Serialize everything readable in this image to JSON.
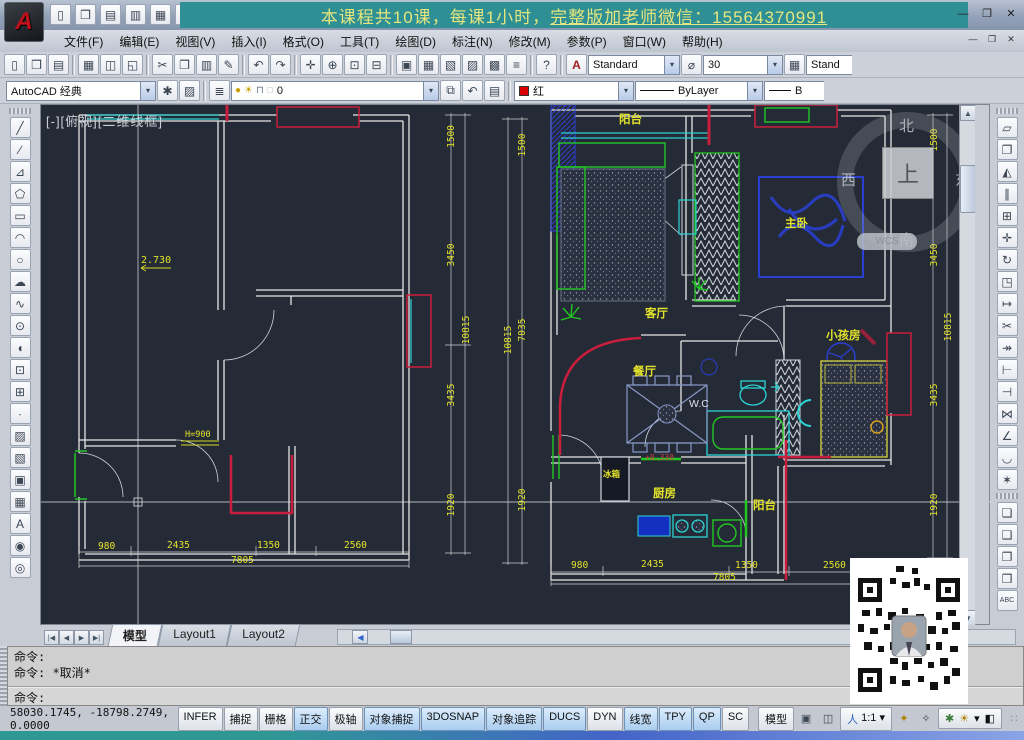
{
  "window": {
    "banner_part1": "本课程共10课，每课1小时，",
    "banner_part2": "完整版加老师微信：15564370991",
    "controls": {
      "minimize": "—",
      "maximize": "❐",
      "close": "✕"
    },
    "doc_controls": {
      "minimize": "—",
      "restore": "❐",
      "close": "✕"
    }
  },
  "menu": {
    "items": [
      "文件(F)",
      "编辑(E)",
      "视图(V)",
      "插入(I)",
      "格式(O)",
      "工具(T)",
      "绘图(D)",
      "标注(N)",
      "修改(M)",
      "参数(P)",
      "窗口(W)",
      "帮助(H)"
    ]
  },
  "toolbars": {
    "quick_access": [
      {
        "name": "new-icon",
        "glyph": "▯"
      },
      {
        "name": "open-icon",
        "glyph": "❒"
      },
      {
        "name": "save-icon",
        "glyph": "▤"
      },
      {
        "name": "saveas-icon",
        "glyph": "▥"
      },
      {
        "name": "plot-icon",
        "glyph": "▦"
      },
      {
        "name": "undo-icon",
        "glyph": "↶"
      }
    ],
    "standard": [
      {
        "name": "new-icon",
        "glyph": "▯"
      },
      {
        "name": "open-icon",
        "glyph": "❒"
      },
      {
        "name": "save-icon",
        "glyph": "▤"
      },
      {
        "sep": true
      },
      {
        "name": "plot-icon",
        "glyph": "▦"
      },
      {
        "name": "plot-preview-icon",
        "glyph": "◫"
      },
      {
        "name": "publish-icon",
        "glyph": "◱"
      },
      {
        "sep": true
      },
      {
        "name": "cut-icon",
        "glyph": "✂"
      },
      {
        "name": "copy-icon",
        "glyph": "❐"
      },
      {
        "name": "paste-icon",
        "glyph": "▥"
      },
      {
        "name": "match-properties-icon",
        "glyph": "✎"
      },
      {
        "sep": true
      },
      {
        "name": "undo-icon",
        "glyph": "↶"
      },
      {
        "name": "redo-icon",
        "glyph": "↷"
      },
      {
        "sep": true
      },
      {
        "name": "pan-icon",
        "glyph": "✛"
      },
      {
        "name": "zoom-realtime-icon",
        "glyph": "⊕"
      },
      {
        "name": "zoom-window-icon",
        "glyph": "⊡"
      },
      {
        "name": "zoom-previous-icon",
        "glyph": "⊟"
      },
      {
        "sep": true
      },
      {
        "name": "properties-icon",
        "glyph": "▣"
      },
      {
        "name": "designcenter-icon",
        "glyph": "▦"
      },
      {
        "name": "tool-palettes-icon",
        "glyph": "▧"
      },
      {
        "name": "sheet-set-icon",
        "glyph": "▨"
      },
      {
        "name": "markup-icon",
        "glyph": "▩"
      },
      {
        "name": "quickcalc-icon",
        "glyph": "≡"
      },
      {
        "sep": true
      },
      {
        "name": "help-icon",
        "glyph": "?"
      }
    ],
    "styles": {
      "text_style": "Standard",
      "dim_scale": "30",
      "dim_style": "Stand"
    },
    "workspace": {
      "value": "AutoCAD 经典"
    },
    "layers": {
      "current": "0"
    },
    "properties": {
      "color": "红",
      "linetype": "ByLayer",
      "lineweight": "B"
    }
  },
  "draw_tools": [
    {
      "name": "line-icon",
      "glyph": "╱"
    },
    {
      "name": "construction-line-icon",
      "glyph": "∕"
    },
    {
      "name": "polyline-icon",
      "glyph": "⊿"
    },
    {
      "name": "polygon-icon",
      "glyph": "⬠"
    },
    {
      "name": "rectangle-icon",
      "glyph": "▭"
    },
    {
      "name": "arc-icon",
      "glyph": "◠"
    },
    {
      "name": "circle-icon",
      "glyph": "○"
    },
    {
      "name": "revision-cloud-icon",
      "glyph": "☁"
    },
    {
      "name": "spline-icon",
      "glyph": "∿"
    },
    {
      "name": "ellipse-icon",
      "glyph": "⊙"
    },
    {
      "name": "ellipse-arc-icon",
      "glyph": "◖"
    },
    {
      "name": "insert-block-icon",
      "glyph": "⊡"
    },
    {
      "name": "make-block-icon",
      "glyph": "⊞"
    },
    {
      "name": "point-icon",
      "glyph": "∙"
    },
    {
      "name": "hatch-icon",
      "glyph": "▨"
    },
    {
      "name": "gradient-icon",
      "glyph": "▧"
    },
    {
      "name": "region-icon",
      "glyph": "▣"
    },
    {
      "name": "table-icon",
      "glyph": "▦"
    },
    {
      "name": "multiline-text-icon",
      "glyph": "A"
    },
    {
      "name": "divide-icon",
      "glyph": "◉"
    },
    {
      "name": "measure-icon",
      "glyph": "◎"
    }
  ],
  "modify_tools": [
    {
      "name": "erase-icon",
      "glyph": "▱"
    },
    {
      "name": "copy-icon",
      "glyph": "❐"
    },
    {
      "name": "mirror-icon",
      "glyph": "◭"
    },
    {
      "name": "offset-icon",
      "glyph": "∥"
    },
    {
      "name": "array-icon",
      "glyph": "⊞"
    },
    {
      "name": "move-icon",
      "glyph": "✛"
    },
    {
      "name": "rotate-icon",
      "glyph": "↻"
    },
    {
      "name": "scale-icon",
      "glyph": "◳"
    },
    {
      "name": "stretch-icon",
      "glyph": "↦"
    },
    {
      "name": "trim-icon",
      "glyph": "✂"
    },
    {
      "name": "extend-icon",
      "glyph": "↠"
    },
    {
      "name": "break-at-point-icon",
      "glyph": "⊢"
    },
    {
      "name": "break-icon",
      "glyph": "⊣"
    },
    {
      "name": "join-icon",
      "glyph": "⋈"
    },
    {
      "name": "chamfer-icon",
      "glyph": "∠"
    },
    {
      "name": "fillet-icon",
      "glyph": "◡"
    },
    {
      "name": "explode-icon",
      "glyph": "✶"
    }
  ],
  "draworder_tools": [
    {
      "name": "bring-to-front-icon",
      "glyph": "❏"
    },
    {
      "name": "send-to-back-icon",
      "glyph": "❑"
    },
    {
      "name": "bring-above-icon",
      "glyph": "❐"
    },
    {
      "name": "send-under-icon",
      "glyph": "❒"
    },
    {
      "name": "text-to-front-icon",
      "glyph": "ABC"
    }
  ],
  "drawing": {
    "viewport_label": "[-][俯视][二维线框]",
    "viewcube": {
      "north": "北",
      "south": "南",
      "east": "东",
      "west": "西",
      "top": "上",
      "wcs": "WCS"
    },
    "rooms": {
      "balcony_top": "阳台",
      "living": "客厅",
      "master": "主卧",
      "kids": "小孩房",
      "dining": "餐厅",
      "wc": "W.C",
      "kitchen": "厨房",
      "balcony_bottom": "阳台",
      "fridge": "冰箱"
    },
    "annotations": {
      "elevation": "2.730",
      "window_height": "H=900",
      "level": "+0.330"
    },
    "dims": {
      "d980": "980",
      "d2435": "2435",
      "d1350": "1350",
      "d2560": "2560",
      "d7805": "7805",
      "d1500": "1500",
      "d3450": "3450",
      "d3435": "3435",
      "d1920": "1920",
      "d10815": "10815",
      "d7035": "7035"
    },
    "colors": {
      "background": "#252b36",
      "walls": "#e6e6e6",
      "dimensions": "#e3e32a",
      "red": "#c81e3c",
      "cyan": "#2ad4d4",
      "green": "#22c822",
      "blue": "#2a3fd0"
    }
  },
  "tabs": {
    "nav": [
      "|◀",
      "◀",
      "▶",
      "▶|"
    ],
    "model": "模型",
    "layout1": "Layout1",
    "layout2": "Layout2"
  },
  "command": {
    "history1": "命令:",
    "history2": "命令: *取消*",
    "current": "命令:"
  },
  "status": {
    "coords": "58030.1745, -18798.2749,  0.0000",
    "toggles": [
      {
        "label": "INFER",
        "on": false
      },
      {
        "label": "捕捉",
        "on": false
      },
      {
        "label": "栅格",
        "on": false
      },
      {
        "label": "正交",
        "on": true
      },
      {
        "label": "极轴",
        "on": false
      },
      {
        "label": "对象捕捉",
        "on": true
      },
      {
        "label": "3DOSNAP",
        "on": true
      },
      {
        "label": "对象追踪",
        "on": true
      },
      {
        "label": "DUCS",
        "on": true
      },
      {
        "label": "DYN",
        "on": false
      },
      {
        "label": "线宽",
        "on": true
      },
      {
        "label": "TPY",
        "on": true
      },
      {
        "label": "QP",
        "on": true
      },
      {
        "label": "SC",
        "on": false
      }
    ],
    "model_button": "模型",
    "scale_prefix": "人",
    "annotation_scale": "1:1 ▾",
    "tray_icons": [
      {
        "name": "layout-icon",
        "glyph": "▣"
      },
      {
        "name": "quick-view-icon",
        "glyph": "◫"
      },
      {
        "name": "annotation-visibility-icon",
        "glyph": "✦"
      },
      {
        "name": "auto-annotate-icon",
        "glyph": "✧"
      },
      {
        "name": "workspace-gear-icon",
        "glyph": "✱"
      },
      {
        "name": "status-bulb-icon",
        "glyph": "☀"
      },
      {
        "name": "tray-arrow-icon",
        "glyph": "▾"
      },
      {
        "name": "clean-screen-icon",
        "glyph": "◧"
      }
    ]
  }
}
